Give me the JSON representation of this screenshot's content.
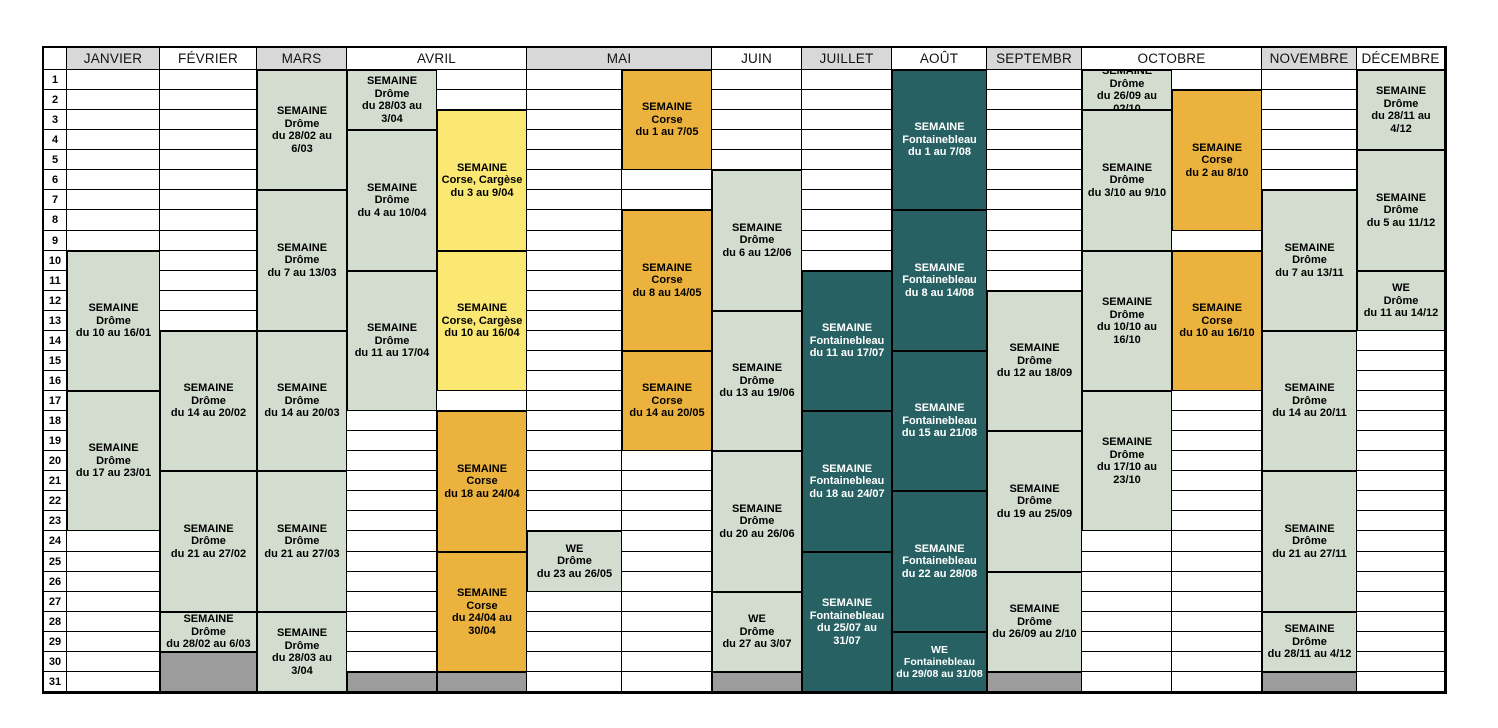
{
  "calendar": {
    "corner_label": "",
    "months": [
      {
        "label": "JANVIER",
        "gray": true,
        "span": 1
      },
      {
        "label": "FÉVRIER",
        "gray": false,
        "span": 1
      },
      {
        "label": "MARS",
        "gray": true,
        "span": 1
      },
      {
        "label": "AVRIL",
        "gray": false,
        "span": 2
      },
      {
        "label": "MAI",
        "gray": true,
        "span": 2
      },
      {
        "label": "JUIN",
        "gray": false,
        "span": 1
      },
      {
        "label": "JUILLET",
        "gray": true,
        "span": 1
      },
      {
        "label": "AOÛT",
        "gray": false,
        "span": 1
      },
      {
        "label": "SEPTEMBR",
        "gray": true,
        "span": 1
      },
      {
        "label": "OCTOBRE",
        "gray": false,
        "span": 2
      },
      {
        "label": "NOVEMBRE",
        "gray": true,
        "span": 1
      },
      {
        "label": "DÉCEMBRE",
        "gray": false,
        "span": 1
      }
    ],
    "day_numbers": [
      1,
      2,
      3,
      4,
      5,
      6,
      7,
      8,
      9,
      10,
      11,
      12,
      13,
      14,
      15,
      16,
      17,
      18,
      19,
      20,
      21,
      22,
      23,
      24,
      25,
      26,
      27,
      28,
      29,
      30,
      31
    ],
    "colors": {
      "green": "#d3ddcf",
      "yellow": "#fae873",
      "orange": "#ecb23e",
      "teal": "#286163",
      "filler": "#9c9c9c",
      "header_gray": "#d8d8d8",
      "teal_text": "#ffffff",
      "text": "#000000",
      "border": "#000000"
    },
    "events": [
      {
        "col": 0,
        "start": 10,
        "end": 16,
        "color": "green",
        "lines": [
          "SEMAINE",
          "Drôme",
          "du 10 au 16/01"
        ]
      },
      {
        "col": 0,
        "start": 17,
        "end": 23,
        "color": "green",
        "lines": [
          "SEMAINE",
          "Drôme",
          "du 17 au 23/01"
        ]
      },
      {
        "col": 1,
        "start": 14,
        "end": 20,
        "color": "green",
        "lines": [
          "SEMAINE",
          "Drôme",
          "du 14 au 20/02"
        ]
      },
      {
        "col": 1,
        "start": 21,
        "end": 27,
        "color": "green",
        "lines": [
          "SEMAINE",
          "Drôme",
          "du 21 au 27/02"
        ]
      },
      {
        "col": 1,
        "start": 28,
        "end": 29,
        "color": "green",
        "lines": [
          "SEMAINE",
          "Drôme",
          "du 28/02 au 6/03"
        ]
      },
      {
        "col": 1,
        "start": 30,
        "end": 31,
        "color": "filler",
        "lines": []
      },
      {
        "col": 2,
        "start": 1,
        "end": 6,
        "color": "green",
        "lines": [
          "SEMAINE",
          "Drôme",
          "du 28/02 au 6/03"
        ]
      },
      {
        "col": 2,
        "start": 7,
        "end": 13,
        "color": "green",
        "lines": [
          "SEMAINE",
          "Drôme",
          "du 7 au 13/03"
        ]
      },
      {
        "col": 2,
        "start": 14,
        "end": 20,
        "color": "green",
        "lines": [
          "SEMAINE",
          "Drôme",
          "du 14 au 20/03"
        ]
      },
      {
        "col": 2,
        "start": 21,
        "end": 27,
        "color": "green",
        "lines": [
          "SEMAINE",
          "Drôme",
          "du 21 au 27/03"
        ]
      },
      {
        "col": 2,
        "start": 28,
        "end": 31,
        "color": "green",
        "lines": [
          "SEMAINE",
          "Drôme",
          "du 28/03 au 3/04"
        ]
      },
      {
        "col": 3,
        "start": 1,
        "end": 3,
        "color": "green",
        "lines": [
          "SEMAINE",
          "Drôme",
          "du 28/03 au 3/04"
        ]
      },
      {
        "col": 3,
        "start": 4,
        "end": 10,
        "color": "green",
        "lines": [
          "SEMAINE",
          "Drôme",
          "du 4 au 10/04"
        ]
      },
      {
        "col": 3,
        "start": 11,
        "end": 17,
        "color": "green",
        "lines": [
          "SEMAINE",
          "Drôme",
          "du 11 au 17/04"
        ]
      },
      {
        "col": 3,
        "start": 31,
        "end": 31,
        "color": "filler",
        "lines": []
      },
      {
        "col": 4,
        "start": 3,
        "end": 9,
        "color": "yellow",
        "lines": [
          "SEMAINE",
          "Corse, Cargèse",
          "du 3 au 9/04"
        ]
      },
      {
        "col": 4,
        "start": 10,
        "end": 16,
        "color": "yellow",
        "lines": [
          "SEMAINE",
          "Corse, Cargèse",
          "du 10 au 16/04"
        ]
      },
      {
        "col": 4,
        "start": 18,
        "end": 24,
        "color": "orange",
        "lines": [
          "SEMAINE",
          "Corse",
          "du 18 au 24/04"
        ]
      },
      {
        "col": 4,
        "start": 25,
        "end": 30,
        "color": "orange",
        "lines": [
          "SEMAINE",
          "Corse",
          "du 24/04 au 30/04"
        ]
      },
      {
        "col": 4,
        "start": 31,
        "end": 31,
        "color": "filler",
        "lines": []
      },
      {
        "col": 5,
        "start": 24,
        "end": 26,
        "color": "green",
        "lines": [
          "WE",
          "Drôme",
          "du 23 au 26/05"
        ]
      },
      {
        "col": 6,
        "start": 1,
        "end": 5,
        "color": "orange",
        "lines": [
          "SEMAINE",
          "Corse",
          "du 1 au 7/05"
        ]
      },
      {
        "col": 6,
        "start": 8,
        "end": 14,
        "color": "orange",
        "lines": [
          "SEMAINE",
          "Corse",
          "du 8 au 14/05"
        ]
      },
      {
        "col": 6,
        "start": 15,
        "end": 19,
        "color": "orange",
        "lines": [
          "SEMAINE",
          "Corse",
          "du 14 au 20/05"
        ]
      },
      {
        "col": 7,
        "start": 6,
        "end": 12,
        "color": "green",
        "lines": [
          "SEMAINE",
          "Drôme",
          "du 6 au 12/06"
        ]
      },
      {
        "col": 7,
        "start": 13,
        "end": 19,
        "color": "green",
        "lines": [
          "SEMAINE",
          "Drôme",
          "du 13 au 19/06"
        ]
      },
      {
        "col": 7,
        "start": 20,
        "end": 26,
        "color": "green",
        "lines": [
          "SEMAINE",
          "Drôme",
          "du 20 au 26/06"
        ]
      },
      {
        "col": 7,
        "start": 27,
        "end": 30,
        "color": "green",
        "lines": [
          "WE",
          "Drôme",
          "du 27 au 3/07"
        ]
      },
      {
        "col": 7,
        "start": 31,
        "end": 31,
        "color": "filler",
        "lines": []
      },
      {
        "col": 8,
        "start": 11,
        "end": 17,
        "color": "teal",
        "lines": [
          "SEMAINE",
          "Fontainebleau",
          "du 11 au 17/07"
        ]
      },
      {
        "col": 8,
        "start": 18,
        "end": 24,
        "color": "teal",
        "lines": [
          "SEMAINE",
          "Fontainebleau",
          "du 18 au 24/07"
        ]
      },
      {
        "col": 8,
        "start": 25,
        "end": 31,
        "color": "teal",
        "lines": [
          "SEMAINE",
          "Fontainebleau",
          "du 25/07 au 31/07"
        ]
      },
      {
        "col": 9,
        "start": 1,
        "end": 7,
        "color": "teal",
        "lines": [
          "SEMAINE",
          "Fontainebleau",
          "du 1 au 7/08"
        ]
      },
      {
        "col": 9,
        "start": 8,
        "end": 14,
        "color": "teal",
        "lines": [
          "SEMAINE",
          "Fontainebleau",
          "du 8 au 14/08"
        ]
      },
      {
        "col": 9,
        "start": 15,
        "end": 21,
        "color": "teal",
        "lines": [
          "SEMAINE",
          "Fontainebleau",
          "du 15 au 21/08"
        ]
      },
      {
        "col": 9,
        "start": 22,
        "end": 28,
        "color": "teal",
        "lines": [
          "SEMAINE",
          "Fontainebleau",
          "du 22 au 28/08"
        ]
      },
      {
        "col": 9,
        "start": 29,
        "end": 31,
        "color": "teal",
        "small": true,
        "lines": [
          "WE Fontainebleau",
          "du 29/08 au 31/08"
        ]
      },
      {
        "col": 10,
        "start": 12,
        "end": 18,
        "color": "green",
        "lines": [
          "SEMAINE",
          "Drôme",
          "du 12 au 18/09"
        ]
      },
      {
        "col": 10,
        "start": 19,
        "end": 25,
        "color": "green",
        "lines": [
          "SEMAINE",
          "Drôme",
          "du 19 au 25/09"
        ]
      },
      {
        "col": 10,
        "start": 26,
        "end": 30,
        "color": "green",
        "lines": [
          "SEMAINE",
          "Drôme",
          "du 26/09 au 2/10"
        ]
      },
      {
        "col": 10,
        "start": 31,
        "end": 31,
        "color": "filler",
        "lines": []
      },
      {
        "col": 11,
        "start": 1,
        "end": 2,
        "color": "green",
        "lines": [
          "SEMAINE",
          "Drôme",
          "du 26/09 au 02/10"
        ]
      },
      {
        "col": 11,
        "start": 3,
        "end": 9,
        "color": "green",
        "lines": [
          "SEMAINE",
          "Drôme",
          "du 3/10 au 9/10"
        ]
      },
      {
        "col": 11,
        "start": 10,
        "end": 16,
        "color": "green",
        "lines": [
          "SEMAINE",
          "Drôme",
          "du 10/10 au 16/10"
        ]
      },
      {
        "col": 11,
        "start": 17,
        "end": 23,
        "color": "green",
        "lines": [
          "SEMAINE",
          "Drôme",
          "du 17/10 au 23/10"
        ]
      },
      {
        "col": 12,
        "start": 2,
        "end": 8,
        "color": "orange",
        "lines": [
          "SEMAINE",
          "Corse",
          "du 2 au 8/10"
        ]
      },
      {
        "col": 12,
        "start": 10,
        "end": 16,
        "color": "orange",
        "lines": [
          "SEMAINE",
          "Corse",
          "du 10 au 16/10"
        ]
      },
      {
        "col": 13,
        "start": 7,
        "end": 13,
        "color": "green",
        "lines": [
          "SEMAINE",
          "Drôme",
          "du 7 au 13/11"
        ]
      },
      {
        "col": 13,
        "start": 14,
        "end": 20,
        "color": "green",
        "lines": [
          "SEMAINE",
          "Drôme",
          "du 14 au 20/11"
        ]
      },
      {
        "col": 13,
        "start": 21,
        "end": 27,
        "color": "green",
        "lines": [
          "SEMAINE",
          "Drôme",
          "du 21 au 27/11"
        ]
      },
      {
        "col": 13,
        "start": 28,
        "end": 30,
        "color": "green",
        "lines": [
          "SEMAINE",
          "Drôme",
          "du 28/11 au 4/12"
        ]
      },
      {
        "col": 13,
        "start": 31,
        "end": 31,
        "color": "filler",
        "lines": []
      },
      {
        "col": 14,
        "start": 1,
        "end": 4,
        "color": "green",
        "lines": [
          "SEMAINE",
          "Drôme",
          "du 28/11 au 4/12"
        ]
      },
      {
        "col": 14,
        "start": 5,
        "end": 10,
        "color": "green",
        "lines": [
          "SEMAINE",
          "Drôme",
          "du 5 au 11/12"
        ]
      },
      {
        "col": 14,
        "start": 11,
        "end": 13,
        "color": "green",
        "lines": [
          "WE",
          "Drôme",
          "du 11 au 14/12"
        ]
      }
    ]
  }
}
